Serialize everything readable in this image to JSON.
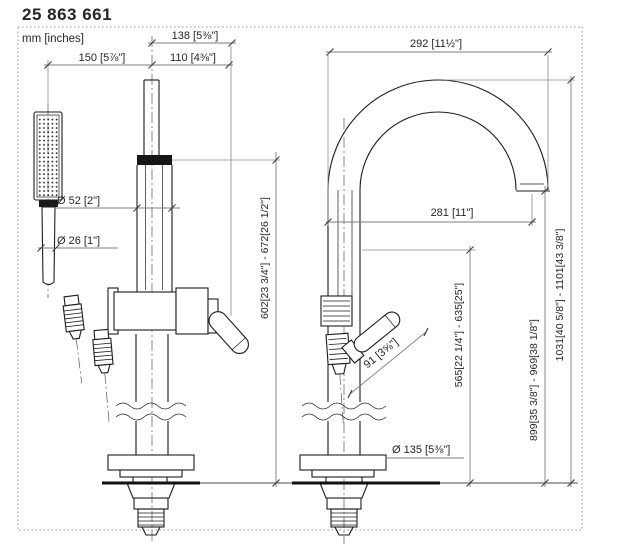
{
  "header": {
    "product_number": "25 863 661",
    "units_note": "mm [inches]"
  },
  "dimensions": {
    "hand_shower_offset": "150 [5⅞\"]",
    "lever_offset": "110 [4⅜\"]",
    "spout_front_width": "138 [5⅜\"]",
    "spout_reach": "292 [11½\"]",
    "outlet_projection": "281 [11\"]",
    "riser_diameter": "Ø 52 [2\"]",
    "hand_shower_diameter": "Ø 26 [1\"]",
    "lever_length": "91 [3⅝\"]",
    "base_diameter": "Ø 135 [5⅜\"]",
    "heights": {
      "hand_shower": "602[23 3/4\"] - 672[26 1/2\"]",
      "body": "565[22 1/4\"] - 635[25\"]",
      "spout": "899[35 3/8\"] - 969[38 1/8\"]",
      "total": "1031[40 5/8\"] - 1101[43 3/8\"]"
    }
  }
}
